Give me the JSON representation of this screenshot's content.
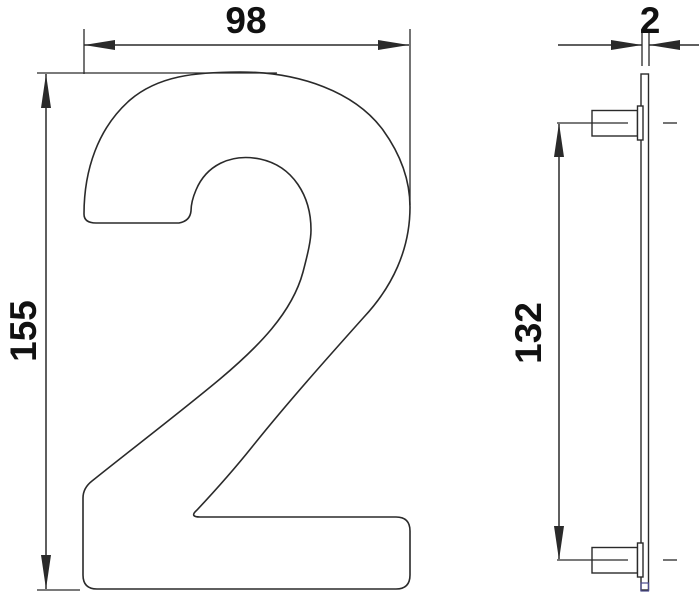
{
  "drawing": {
    "kind": "technical dimension drawing",
    "subject": "house number numeral 2 with fixing studs",
    "front_view": {
      "width_label": "98",
      "height_label": "155",
      "numeral": "2"
    },
    "side_view": {
      "thickness_label": "2",
      "stud_centers_label": "132"
    }
  },
  "colors": {
    "line": "#2a2a2a",
    "text": "#111111",
    "background": "#ffffff",
    "plate_end_accent": "#4b4b8c"
  }
}
